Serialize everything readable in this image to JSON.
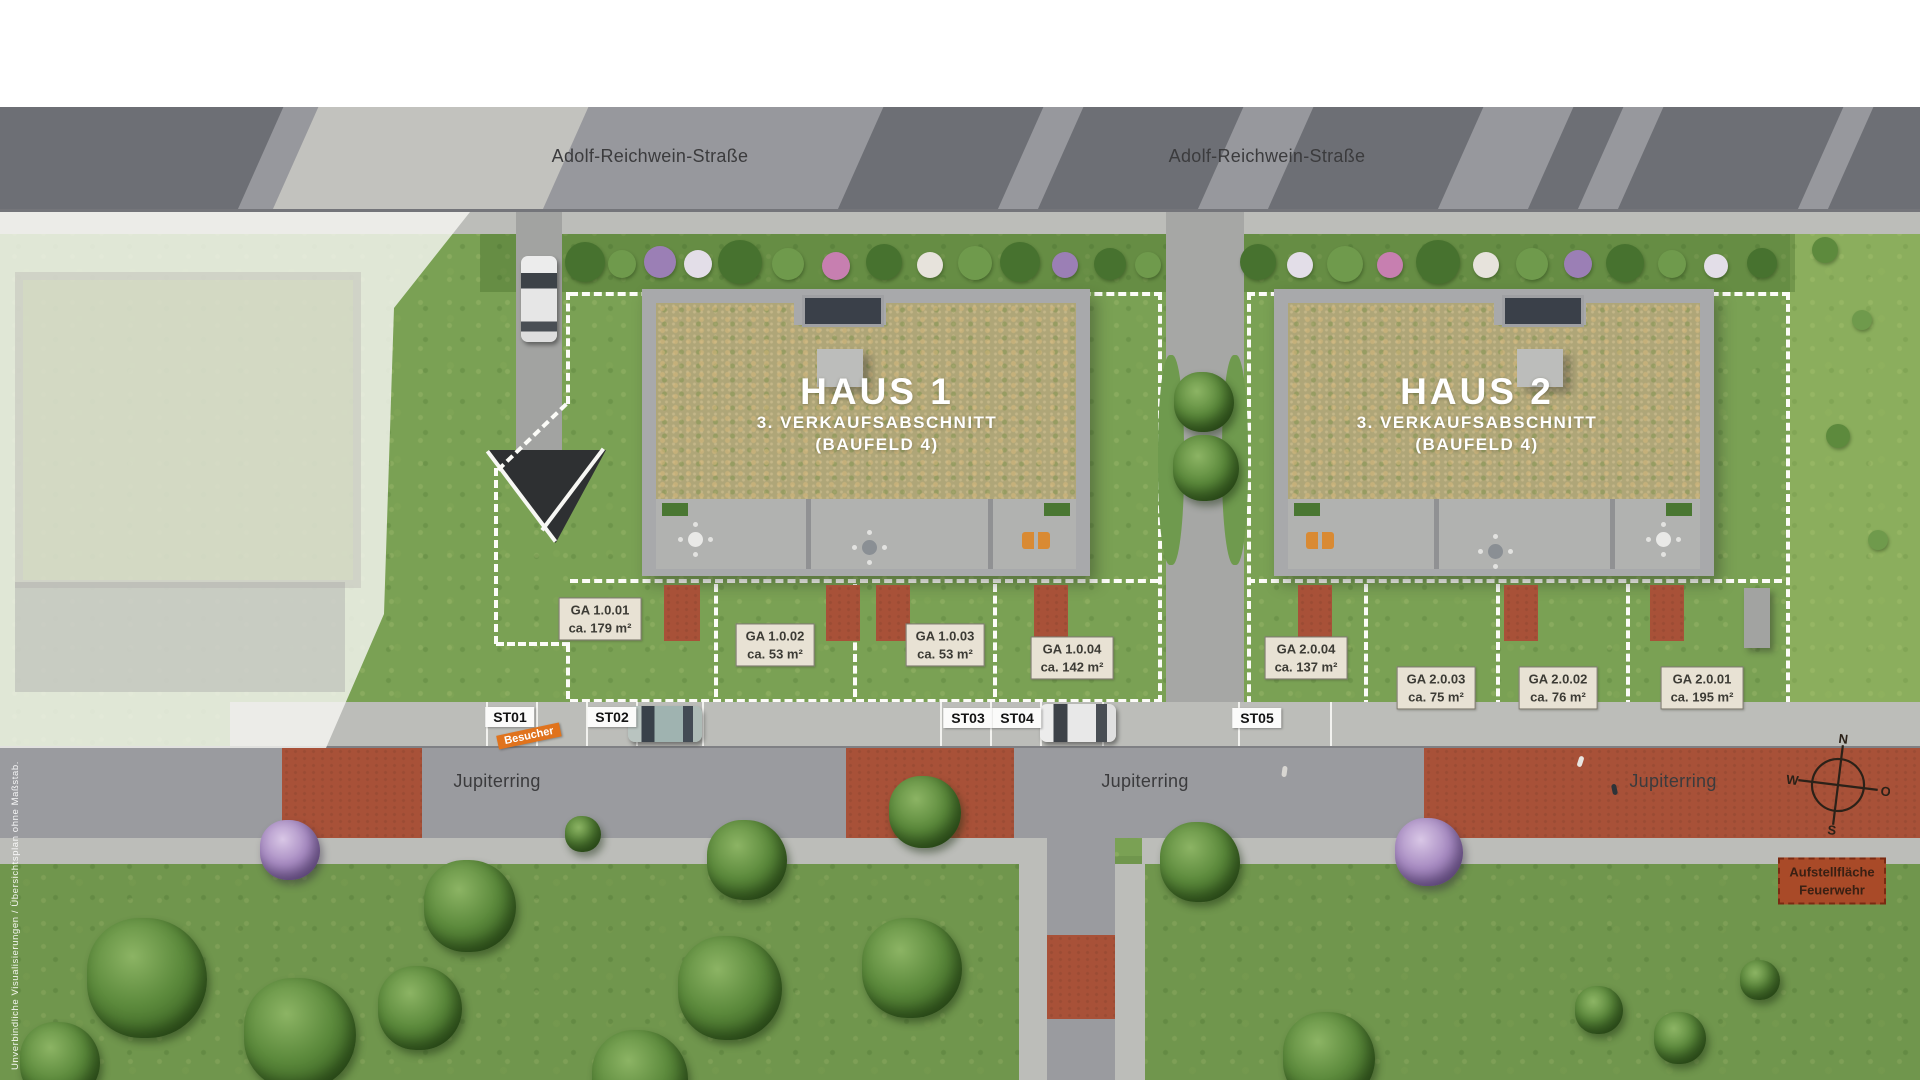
{
  "streets": {
    "top": "Adolf-Reichwein-Straße",
    "bottom": "Jupiterring"
  },
  "houses": [
    {
      "name": "HAUS 1",
      "line2": "3. VERKAUFSABSCHNITT",
      "line3": "(BAUFELD 4)"
    },
    {
      "name": "HAUS 2",
      "line2": "3. VERKAUFSABSCHNITT",
      "line3": "(BAUFELD 4)"
    }
  ],
  "garden_areas": [
    {
      "code": "GA 1.0.01",
      "size": "ca. 179 m²"
    },
    {
      "code": "GA 1.0.02",
      "size": "ca. 53 m²"
    },
    {
      "code": "GA 1.0.03",
      "size": "ca. 53 m²"
    },
    {
      "code": "GA 1.0.04",
      "size": "ca. 142 m²"
    },
    {
      "code": "GA 2.0.04",
      "size": "ca. 137 m²"
    },
    {
      "code": "GA 2.0.03",
      "size": "ca. 75 m²"
    },
    {
      "code": "GA 2.0.02",
      "size": "ca. 76 m²"
    },
    {
      "code": "GA 2.0.01",
      "size": "ca. 195 m²"
    }
  ],
  "parking_spots": [
    {
      "label": "ST01"
    },
    {
      "label": "ST02"
    },
    {
      "label": "ST03"
    },
    {
      "label": "ST04"
    },
    {
      "label": "ST05"
    }
  ],
  "visitor_tag": "Besucher",
  "fire_lane": {
    "line1": "Aufstellfläche",
    "line2": "Feuerwehr"
  },
  "compass": {
    "north": "N",
    "east": "O",
    "south": "S",
    "west": "W"
  },
  "disclaimer": "Unverbindliche Visualisierungen / Übersichtsplan ohne Maßstab.",
  "colors": {
    "grass": "#7aa154",
    "road": "#9a9b9f",
    "red_paving": "#a85138",
    "roof_green": "#afa678",
    "label_bg": "#e8e2d4",
    "visitor_orange": "#e0731d",
    "fire_lane_red": "#a94a28",
    "plot_outline": "#ffffff"
  }
}
